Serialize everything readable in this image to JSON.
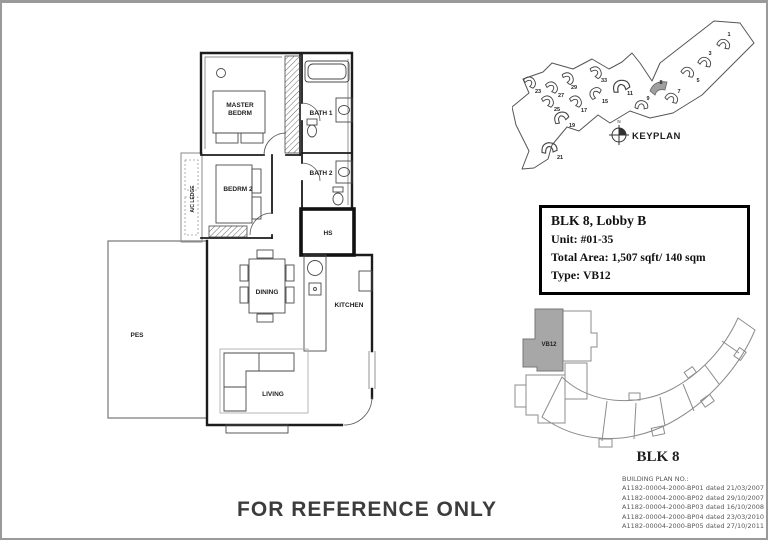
{
  "watermark": "FOR REFERENCE ONLY",
  "floor_plan": {
    "labels": {
      "master_line1": "MASTER",
      "master_line2": "BEDRM",
      "bedroom2": "BEDRM 2",
      "bath1": "BATH 1",
      "bath2": "BATH 2",
      "hs": "HS",
      "ac_ledge": "A/C LEDGE",
      "dining": "DINING",
      "kitchen": "KITCHEN",
      "living": "LIVING",
      "pes": "PES"
    }
  },
  "keyplan": {
    "title": "KEYPLAN",
    "north": "N",
    "highlighted_block": "8",
    "blocks": [
      "1",
      "3",
      "5",
      "7",
      "8",
      "9",
      "11",
      "15",
      "17",
      "19",
      "21",
      "23",
      "25",
      "27",
      "29",
      "33"
    ]
  },
  "unit_info": {
    "title": "BLK 8, Lobby B",
    "unit_label": "Unit:",
    "unit_value": "#01-35",
    "area_label": "Total Area:",
    "area_value": "1,507 sqft/ 140 sqm",
    "type_label": "Type:",
    "type_value": "VB12"
  },
  "block_diagram": {
    "unit_type": "VB12",
    "block_label": "BLK 8"
  },
  "building_plans": {
    "heading": "BUILDING PLAN NO.:",
    "entries": [
      "A1182-00004-2000-BP01 dated 21/03/2007",
      "A1182-00004-2000-BP02 dated 29/10/2007",
      "A1182-00004-2000-BP03 dated 16/10/2008",
      "A1182-00004-2000-BP04 dated 23/03/2010",
      "A1182-00004-2000-BP05 dated 27/10/2011"
    ]
  },
  "colors": {
    "highlight_gray": "#a7a7a7",
    "page_border": "#9a9a9a",
    "line": "#1c1c1c"
  }
}
